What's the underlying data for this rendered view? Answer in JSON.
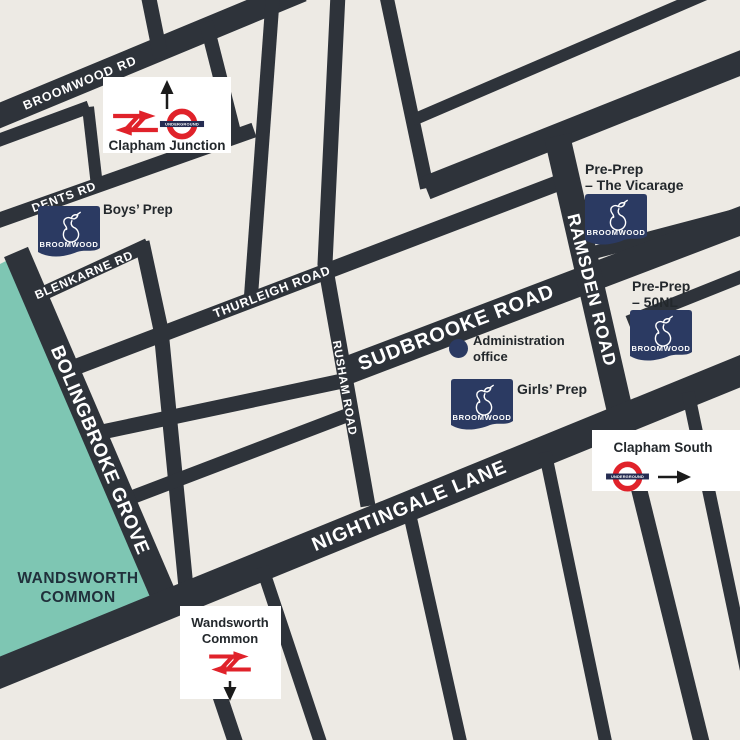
{
  "map": {
    "colors": {
      "background": "#EDEAE4",
      "road": "#2E333A",
      "common_green": "#7EC6B3",
      "brand_navy": "#2B3A62",
      "rail_red": "#E0222A",
      "roundel_bar_blue": "#252C52",
      "label_dark": "#23282C",
      "marker_box_white": "#FFFFFF"
    },
    "road_labels": {
      "broomwood_rd": "BROOMWOOD RD",
      "dents_rd": "DENTS RD",
      "blenkarne_rd": "BLENKARNE RD",
      "thurleigh_road": "THURLEIGH ROAD",
      "rusham_road": "RUSHAM ROAD",
      "sudbrooke_road": "SUDBROOKE ROAD",
      "ramsden_road": "RAMSDEN ROAD",
      "bolingbroke_grove": "BOLINGBROKE GROVE",
      "nightingale_lane": "NIGHTINGALE LANE"
    },
    "areas": {
      "wandsworth_common": {
        "line1": "WANDSWORTH",
        "line2": "COMMON"
      }
    },
    "sites": {
      "boys_prep_label": "Boys’ Prep",
      "girls_prep_label": "Girls’ Prep",
      "pre_prep_vicarage": {
        "line1": "Pre-Prep",
        "line2": "– The Vicarage"
      },
      "pre_prep_50nl": {
        "line1": "Pre-Prep",
        "line2": "– 50NL"
      },
      "admin_office": {
        "line1": "Administration",
        "line2": "office"
      },
      "school_logo_text": "BROOMWOOD"
    },
    "stations": {
      "clapham_junction_label": "Clapham Junction",
      "clapham_south_label": "Clapham South",
      "wandsworth_common_station": {
        "line1": "Wandsworth",
        "line2": "Common"
      },
      "underground_roundel_text": "UNDERGROUND"
    }
  }
}
